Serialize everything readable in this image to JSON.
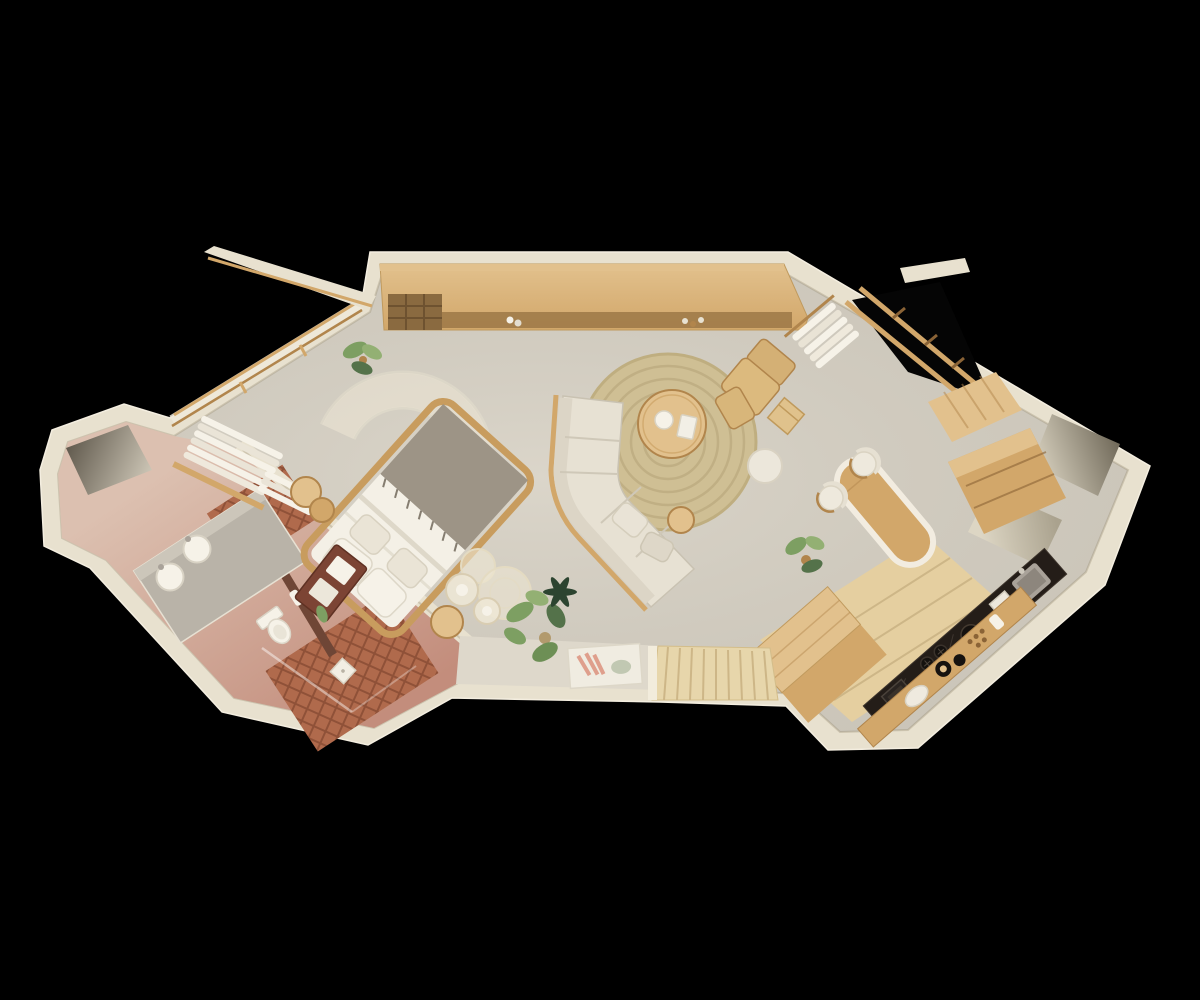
{
  "scene": {
    "type": "3d-floorplan-render",
    "view": "top-down isometric cutaway",
    "subject": "studio suite floor plan on black background",
    "background": "#000000"
  },
  "palette": {
    "background": "#000000",
    "wall": "#e8e1cf",
    "wall_bright": "#f2ecdc",
    "wall_shadow": "#cfc7b2",
    "floor": "#d7d1c4",
    "floor_light": "#ded8cb",
    "bath_pink": "#dcc0b0",
    "bath_rose": "#c38d7c",
    "tile": "#b06a4c",
    "tile_line": "#8f5138",
    "wood": "#d2a76a",
    "wood_light": "#e2c18d",
    "wood_dark": "#b1854c",
    "wood_deep": "#8a6336",
    "deck": "#e7d6ab",
    "deck_line": "#cdb687",
    "marble": "#241d18",
    "marble_vein": "#5a5048",
    "linen": "#f4f0e6",
    "fabric": "#e7e1d3",
    "fabric_shade": "#d4cdbc",
    "throw_gray": "#9d9486",
    "jute": "#cfbf94",
    "jute_dark": "#b5a376",
    "sheer": "#efe8d5",
    "green": "#7d9f62",
    "green_mid": "#93b073",
    "green_dark": "#54724a",
    "green_deep": "#2c4430",
    "art_red": "#7c4434",
    "art_pink": "#df9f8c",
    "art_sage": "#b9c2a9",
    "steel": "#a9a299",
    "black_item": "#16120f",
    "white_soft": "#f6f2e8",
    "glass_line": "#ffffff",
    "brown_wall": "#6f4636"
  },
  "rooms": [
    {
      "name": "bathroom",
      "floor_finish": "rose plaster + terracotta tile"
    },
    {
      "name": "bedroom",
      "floor_finish": "warm concrete"
    },
    {
      "name": "living-area",
      "floor_finish": "warm concrete"
    },
    {
      "name": "kitchen",
      "floor_finish": "wood boards"
    },
    {
      "name": "dining-bar",
      "floor_finish": "warm concrete"
    },
    {
      "name": "entry-deck",
      "floor_finish": "wood slats"
    },
    {
      "name": "storage-niche",
      "floor_finish": "plaster"
    },
    {
      "name": "wardrobe-corner",
      "floor_finish": "warm concrete"
    }
  ],
  "furniture": [
    {
      "name": "double-bed",
      "count": 1
    },
    {
      "name": "bed-canopy-arch",
      "count": 1
    },
    {
      "name": "round-nightstand",
      "count": 3
    },
    {
      "name": "sheer-pouf",
      "count": 2
    },
    {
      "name": "sectional-sofa",
      "count": 1
    },
    {
      "name": "round-jute-rug",
      "count": 1
    },
    {
      "name": "round-coffee-table",
      "count": 1
    },
    {
      "name": "white-pouf",
      "count": 1
    },
    {
      "name": "lounge-chair",
      "count": 1
    },
    {
      "name": "ottoman",
      "count": 1
    },
    {
      "name": "cube-side-table",
      "count": 1
    },
    {
      "name": "bar-table",
      "count": 1
    },
    {
      "name": "bar-chair",
      "count": 2
    },
    {
      "name": "wall-console-with-wine-rack",
      "count": 1
    },
    {
      "name": "kitchen-counter",
      "count": 1
    },
    {
      "name": "kitchen-shelf",
      "count": 1
    },
    {
      "name": "kitchen-island",
      "count": 1
    },
    {
      "name": "storage-cabinet",
      "count": 1
    },
    {
      "name": "vanity-with-two-sinks",
      "count": 1
    },
    {
      "name": "toilet",
      "count": 1
    },
    {
      "name": "shower-glass",
      "count": 1
    },
    {
      "name": "linen-stack",
      "count": 2
    },
    {
      "name": "hanging-towels",
      "count": 1
    },
    {
      "name": "sliding-door-frame",
      "count": 1
    },
    {
      "name": "leaning-bench-art",
      "count": 1
    },
    {
      "name": "floor-artwork",
      "count": 1
    },
    {
      "name": "potted-plant",
      "count": 3
    },
    {
      "name": "entry-deck-boards",
      "count": 1
    }
  ]
}
